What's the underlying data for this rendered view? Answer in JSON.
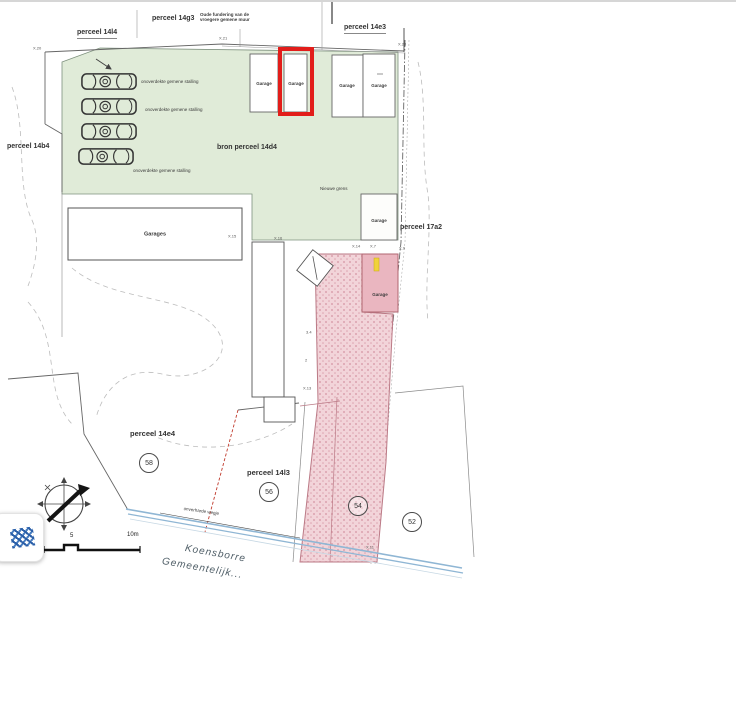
{
  "colors": {
    "green": "#e0ebd8",
    "pink_base": "#f2d4d9",
    "pink_dot": "#dca4b0",
    "pink_solid": "#eab6c0",
    "pink_edge": "#bb7a86",
    "red_highlight": "#e21d1a",
    "street_blue": "#8fb6d4",
    "yellow_mark": "#f0d23c",
    "line": "#666666"
  },
  "parcels": {
    "top_left": "perceel 14l4",
    "top_center": "perceel 14g3",
    "top_right": "perceel 14e3",
    "left": "perceel 14b4",
    "source": "bron perceel 14d4",
    "right": "perceel 17a2",
    "bottom_left": "perceel 14e4",
    "bottom_center": "perceel 14l3"
  },
  "notes": {
    "old_wall": "Oude fundering van de vroegere gemene muur",
    "new_boundary": "Nieuwe grens",
    "parking": "onoverdekte gemene stalling",
    "path": "onverharde wegje"
  },
  "buildings": {
    "garage": "Garage",
    "garages": "Garages"
  },
  "survey": {
    "p20": "X.20",
    "p21": "X.21",
    "p23": "X.23",
    "p15": "X.15",
    "p16": "X.16",
    "p14": "X.14",
    "p7": "X.7",
    "p9": "X.9",
    "p13": "X.13",
    "p11": "X.11"
  },
  "dims": {
    "d1": "3.4",
    "d2": "2"
  },
  "numbers": {
    "n58": "58",
    "n56": "56",
    "n54": "54",
    "n52": "52"
  },
  "street": {
    "line1": "Koensborre",
    "line2": "Gemeentelijk..."
  },
  "scale": {
    "mid": "5",
    "end": "10m"
  },
  "icons": {
    "compass": "compass-rose-icon",
    "pattern_tile": "blue-weave-pattern-icon",
    "cars": "parked-car-icon",
    "north_needle": "compass-needle-icon"
  }
}
